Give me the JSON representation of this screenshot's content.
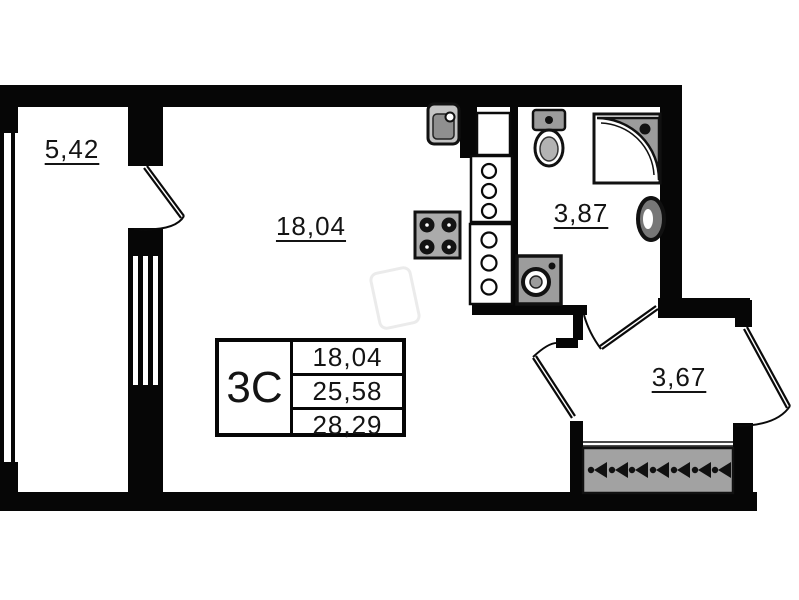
{
  "plan": {
    "rooms": [
      {
        "name": "balcony",
        "area": "5,42"
      },
      {
        "name": "living-room",
        "area": "18,04"
      },
      {
        "name": "bathroom",
        "area": "3,87"
      },
      {
        "name": "hallway",
        "area": "3,67"
      }
    ],
    "legend": {
      "type_code": "3С",
      "rows": [
        {
          "value": "18,04"
        },
        {
          "value": "25,58"
        },
        {
          "value": "28,29"
        }
      ]
    },
    "fixtures": [
      "kitchen-sink-icon",
      "stove-icon",
      "kitchen-cabinet-icon",
      "toilet-icon",
      "shower-icon",
      "washbasin-icon",
      "washing-machine-icon",
      "wardrobe-hangers-icon"
    ],
    "colors": {
      "wall": "#060606",
      "fixture_fill": "#9c9c9c",
      "background": "#ffffff",
      "text": "#141414"
    }
  }
}
